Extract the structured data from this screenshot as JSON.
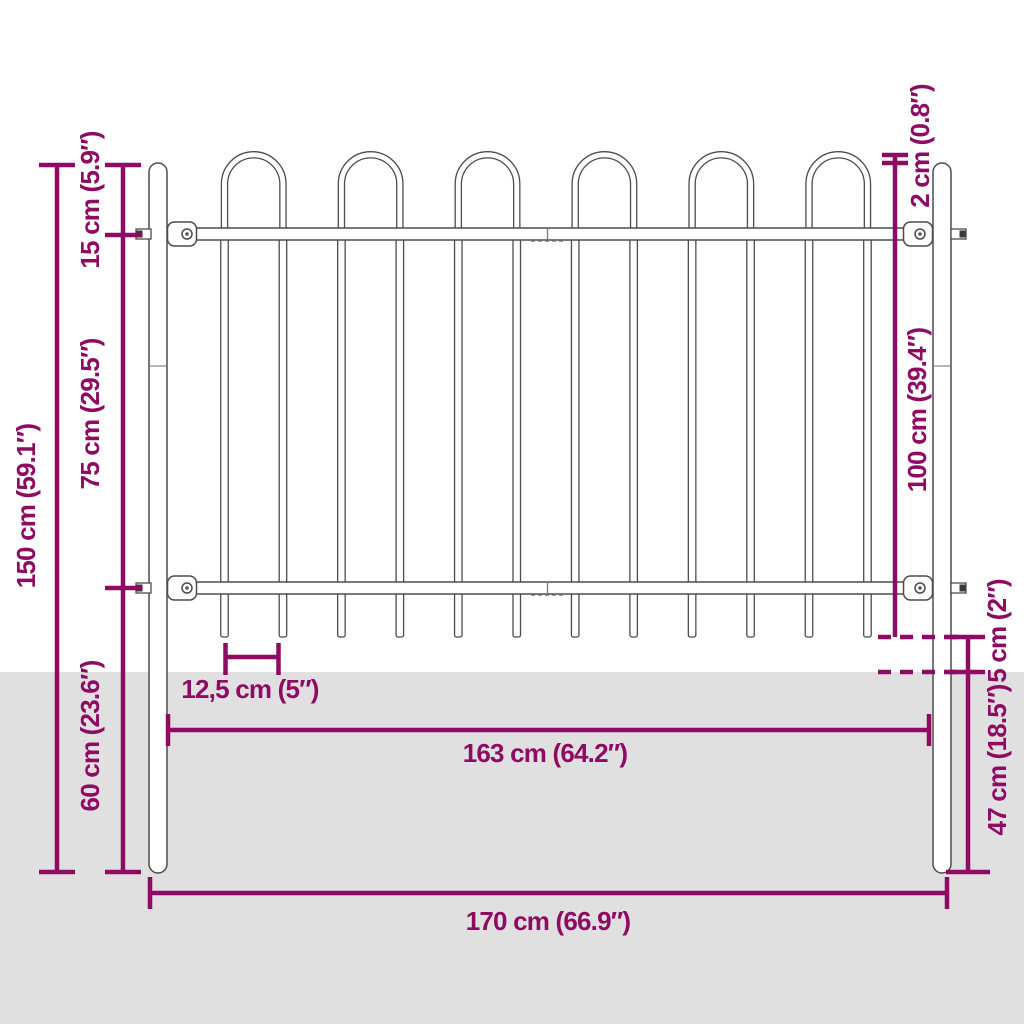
{
  "diagram": {
    "type": "product-dimension-diagram",
    "subject": "steel garden fence with hoop top and ground spikes",
    "colors": {
      "dimension_accent": "#8e0a63",
      "ground_fill": "#e0e0e0",
      "fence_outline": "#4c4c4c",
      "background": "#ffffff"
    },
    "structure": {
      "posts": 2,
      "hoops": 6,
      "vertical_bars": 12,
      "rails": 2
    },
    "dimensions": {
      "total_height": {
        "label": "150 cm (59.1″)",
        "orientation": "vertical"
      },
      "hoop_section_height": {
        "label": "15 cm (5.9″)",
        "orientation": "vertical"
      },
      "rail_spacing": {
        "label": "75 cm (29.5″)",
        "orientation": "vertical"
      },
      "lower_section_height": {
        "label": "60 cm (23.6″)",
        "orientation": "vertical"
      },
      "hoop_above_post": {
        "label": "2 cm (0.8″)",
        "orientation": "vertical"
      },
      "panel_height": {
        "label": "100 cm (39.4″)",
        "orientation": "vertical"
      },
      "spike_to_ground": {
        "label": "5 cm (2″)",
        "orientation": "vertical"
      },
      "post_below_ground": {
        "label": "47 cm (18.5″)",
        "orientation": "vertical"
      },
      "bar_spacing": {
        "label": "12,5 cm (5″)",
        "orientation": "horizontal"
      },
      "panel_width": {
        "label": "163 cm (64.2″)",
        "orientation": "horizontal"
      },
      "total_width": {
        "label": "170 cm (66.9″)",
        "orientation": "horizontal"
      }
    }
  }
}
